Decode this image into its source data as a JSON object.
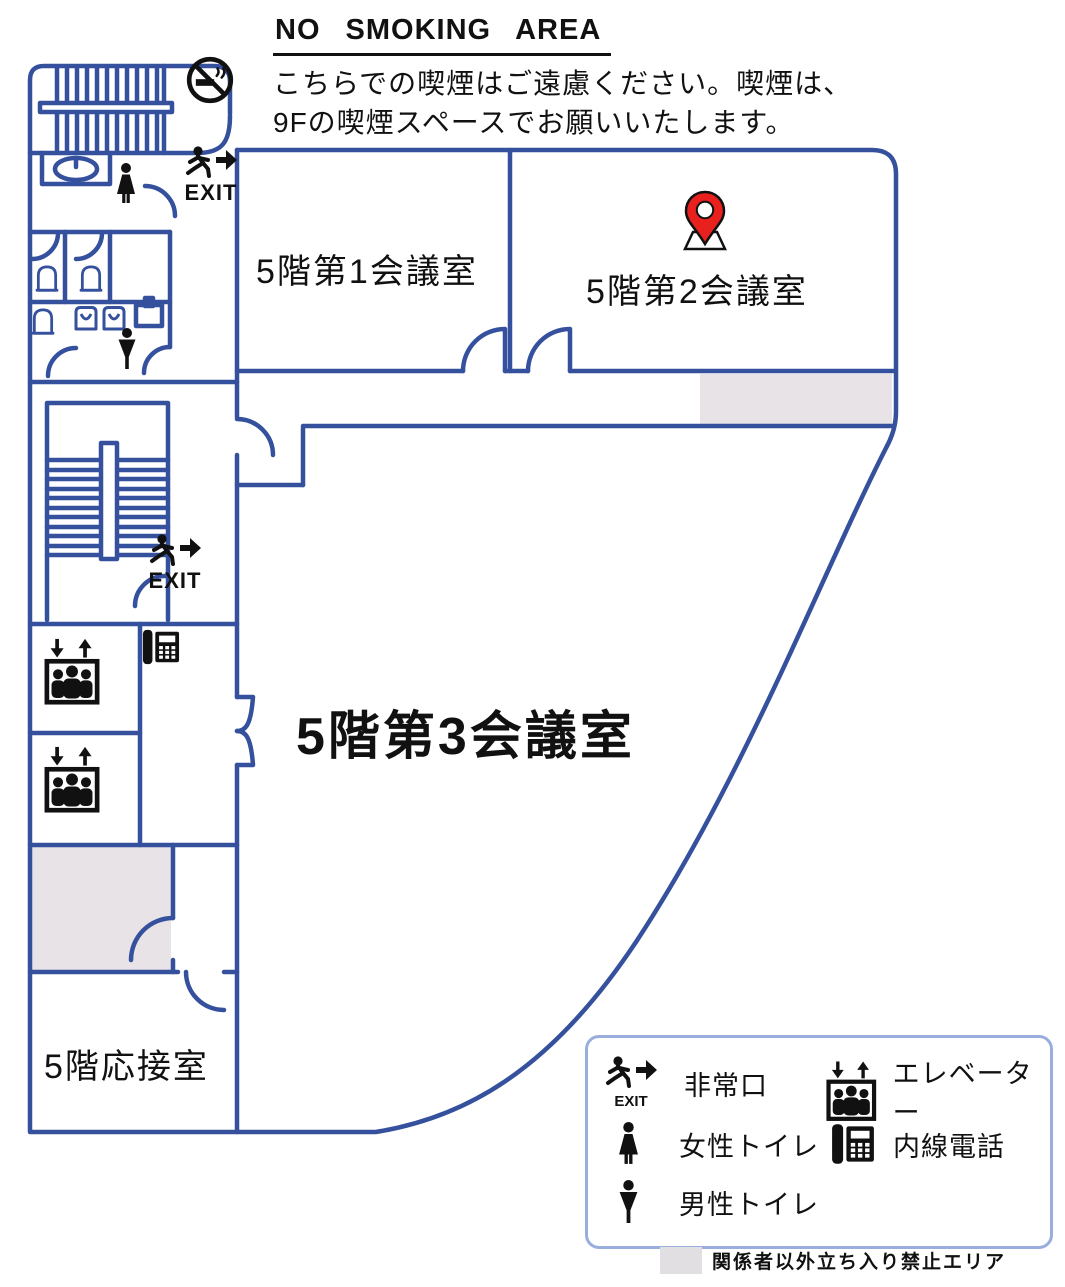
{
  "header": {
    "title": "NO SMOKING AREA",
    "description_line1": "こちらでの喫煙はご遠慮ください。喫煙は、",
    "description_line2": "9Fの喫煙スペースでお願いいたします。"
  },
  "floorplan": {
    "floor": "5F",
    "rooms": [
      {
        "id": "room1",
        "label": "5階第1会議室"
      },
      {
        "id": "room2",
        "label": "5階第2会議室",
        "marker": "location-pin-icon"
      },
      {
        "id": "room3",
        "label": "5階第3会議室"
      },
      {
        "id": "reception",
        "label": "5階応接室"
      }
    ],
    "exit_text": "EXIT",
    "icons": [
      "no-smoking-icon",
      "exit-runner-icon",
      "female-toilet-icon",
      "male-toilet-icon",
      "elevator-icon",
      "phone-icon",
      "location-pin-icon",
      "stairs",
      "toilet-fixtures"
    ]
  },
  "legend": {
    "items": [
      {
        "icon": "emergency-exit-icon",
        "label": "非常口"
      },
      {
        "icon": "elevator-icon",
        "label": "エレベーター"
      },
      {
        "icon": "female-toilet-icon",
        "label": "女性トイレ"
      },
      {
        "icon": "phone-icon",
        "label": "内線電話"
      },
      {
        "icon": "male-toilet-icon",
        "label": "男性トイレ"
      }
    ],
    "restricted_note": "関係者以外立ち入り禁止エリア"
  },
  "colors": {
    "wall": "#35519e",
    "restricted_area": "#e7e3e6",
    "pin_red": "#e8211f",
    "icon_black": "#111111"
  }
}
